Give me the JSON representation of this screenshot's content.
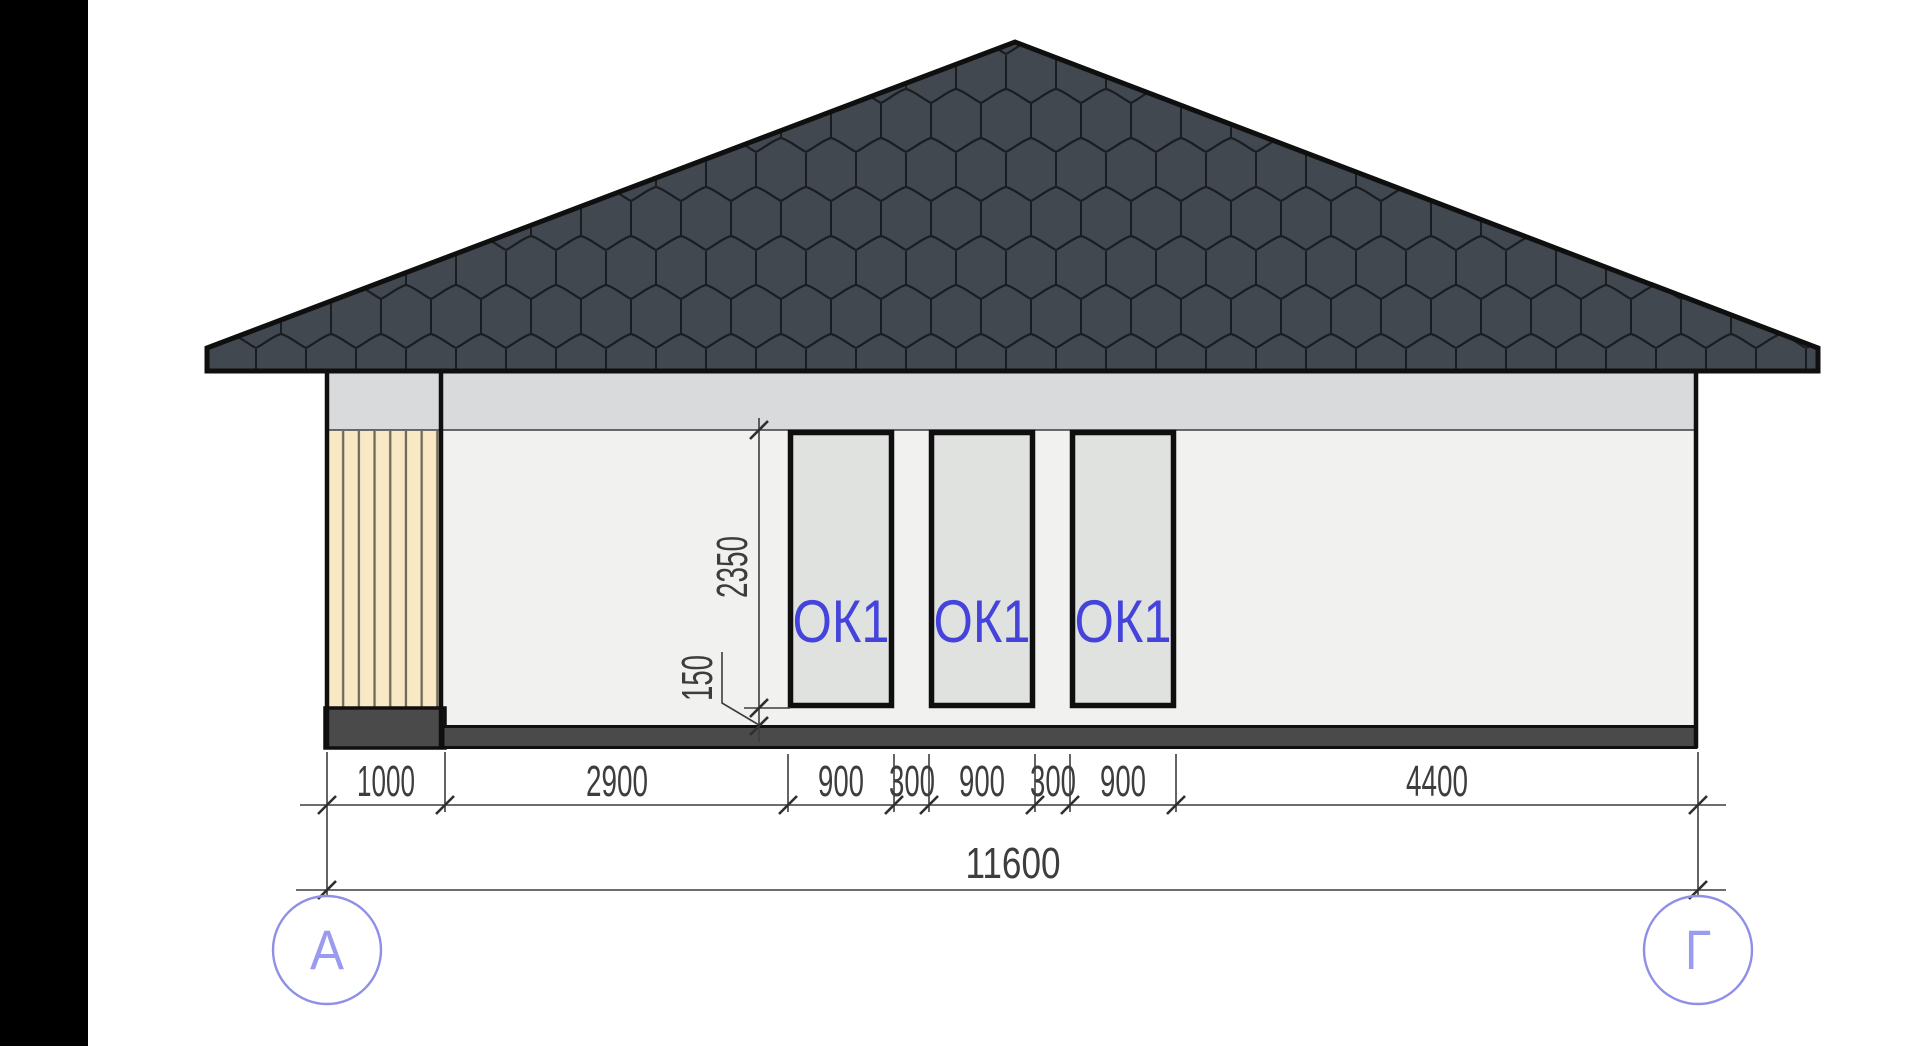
{
  "drawing": {
    "type": "architectural-elevation",
    "windows": [
      "ОК1",
      "ОК1",
      "ОК1"
    ],
    "dims_bottom": [
      "1000",
      "2900",
      "900",
      "300",
      "900",
      "300",
      "900",
      "4400"
    ],
    "dims_total": "11600",
    "dims_vertical": {
      "window_height": "2350",
      "sill_height": "150"
    },
    "axes": [
      "А",
      "Г"
    ],
    "colors": {
      "sidebar": "#000000",
      "background": "#ffffff",
      "roof_fill": "#424850",
      "roof_tile_lines": "#1a1d22",
      "roof_outline": "#0f0f10",
      "soffit_band": "#d8dadc",
      "wall_fill": "#f1f2f0",
      "window_fill": "#dfe2de",
      "window_frame": "#0f0f10",
      "slat_fill": "#f8e9c4",
      "slat_groove": "#6f6a5c",
      "plinth_fill": "#4a4a4b",
      "dimension_lines": "#3d3d3d",
      "window_label_blue": "#4444dd",
      "axis_periwinkle": "#8f8fe8"
    }
  }
}
